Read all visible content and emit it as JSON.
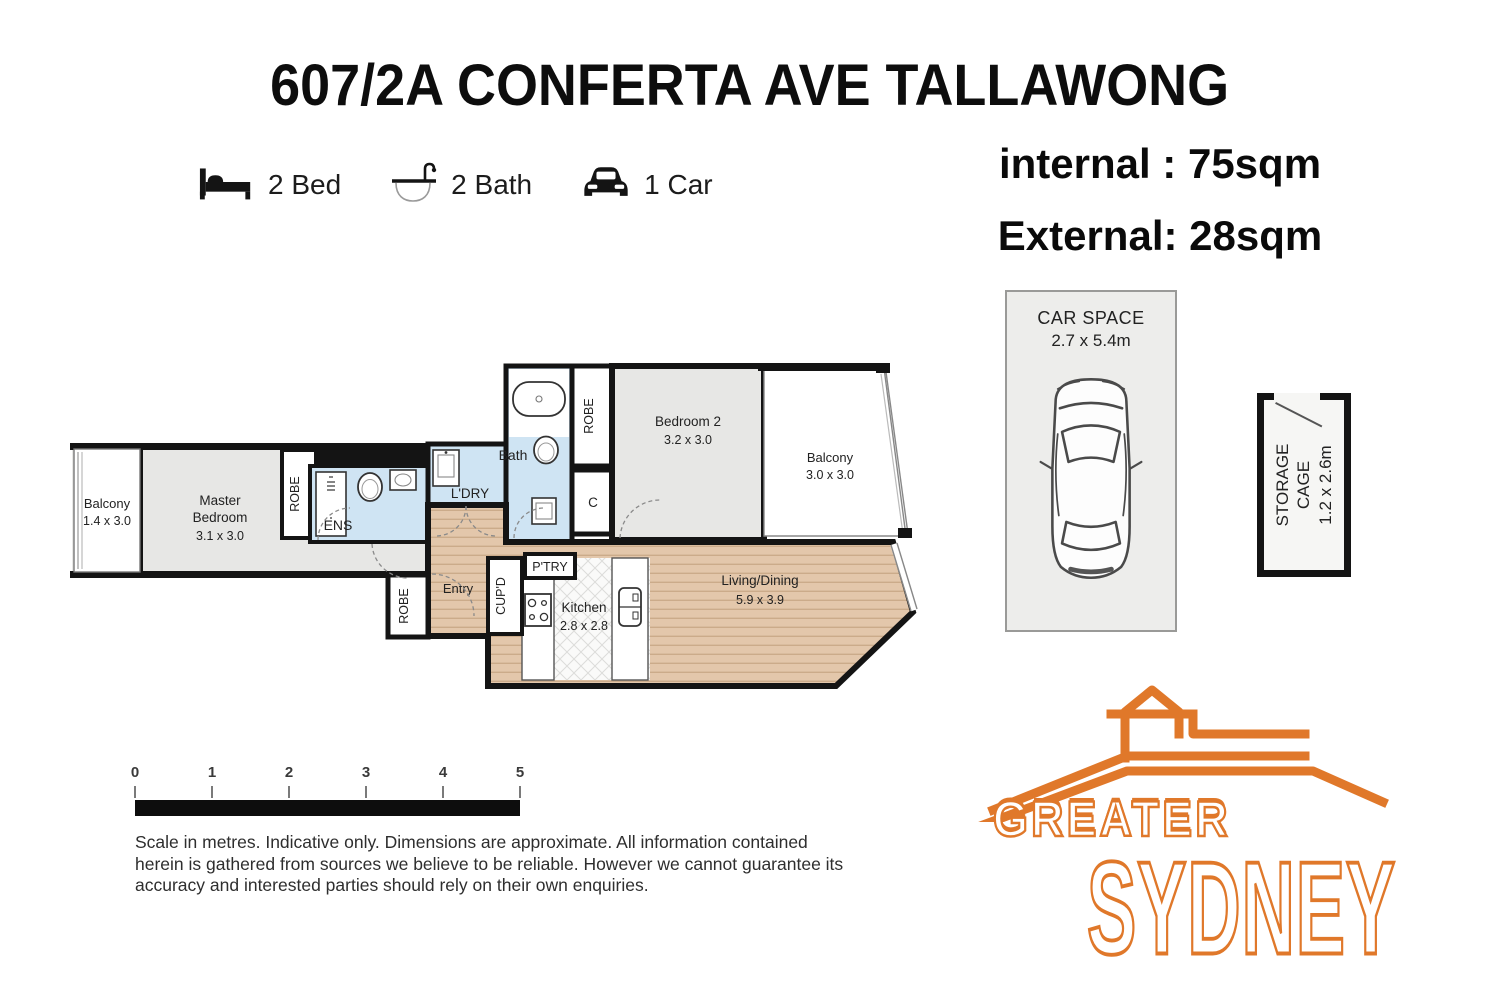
{
  "title": "607/2A CONFERTA AVE TALLAWONG",
  "features": {
    "bed": "2 Bed",
    "bath": "2 Bath",
    "car": "1 Car"
  },
  "areas": {
    "internal": "internal : 75sqm",
    "external": "External: 28sqm"
  },
  "car_space": {
    "title": "CAR SPACE",
    "dims": "2.7 x 5.4m"
  },
  "storage": {
    "line1": "STORAGE",
    "line2": "CAGE",
    "dims": "1.2 x 2.6m"
  },
  "plan": {
    "balcony1_name": "Balcony",
    "balcony1_dims": "1.4 x 3.0",
    "master_1": "Master",
    "master_2": "Bedroom",
    "master_dims": "3.1 x 3.0",
    "robe": "ROBE",
    "ens": "ENS",
    "ldry": "L'DRY",
    "bath": "Bath",
    "c": "C",
    "bed2_name": "Bedroom 2",
    "bed2_dims": "3.2 x 3.0",
    "balcony2_name": "Balcony",
    "balcony2_dims": "3.0 x 3.0",
    "living_name": "Living/Dining",
    "living_dims": "5.9 x 3.9",
    "kitchen_name": "Kitchen",
    "kitchen_dims": "2.8 x 2.8",
    "entry": "Entry",
    "cupd": "CUP'D",
    "ptry": "P'TRY"
  },
  "scale": {
    "ticks": [
      "0",
      "1",
      "2",
      "3",
      "4",
      "5"
    ]
  },
  "disclaimer": "Scale in metres. Indicative only. Dimensions are approximate. All information contained herein is gathered from sources we believe to be reliable. However we cannot guarantee its accuracy and interested parties should rely on their own enquiries.",
  "logo": {
    "line1": "GREATER",
    "line2": "SYDNEY"
  },
  "colors": {
    "accent_orange": "#e0782a",
    "wall": "#141414",
    "carpet": "#e6e6e4",
    "wet_area": "#cfe4f3",
    "timber": "#e3c7ab"
  }
}
